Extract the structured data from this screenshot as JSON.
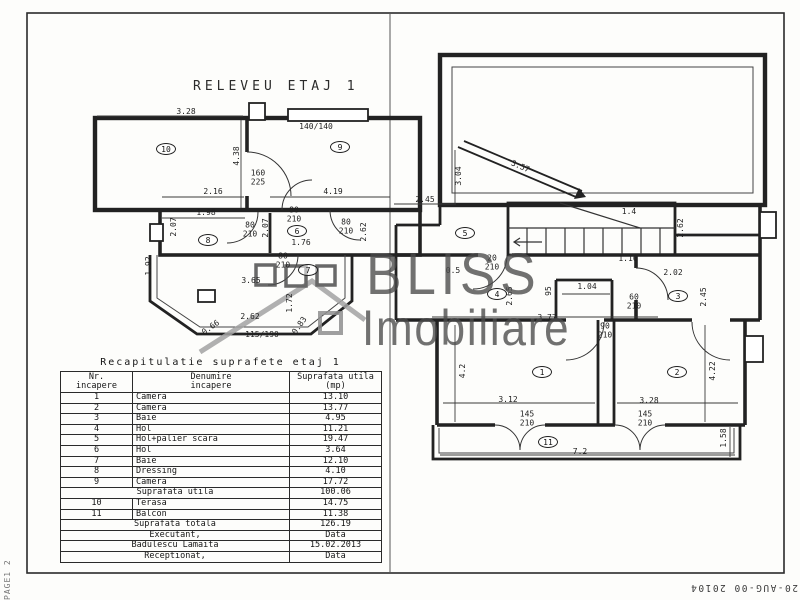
{
  "page": {
    "title": "RELEVEU ETAJ 1",
    "stamp": "20-AUG-00 20104",
    "page_label": "PAGE1 2"
  },
  "watermark": {
    "line1": "BLISS",
    "line2": "Imobiliare"
  },
  "table": {
    "title": "Recapitulatie suprafete etaj 1",
    "headers": {
      "c1": [
        "Nr.",
        "incapere"
      ],
      "c2": [
        "Denumire",
        "incapere"
      ],
      "c3": [
        "Suprafata utila",
        "(mp)"
      ]
    },
    "rows": [
      {
        "nr": "1",
        "name": "Camera",
        "value": "13.10"
      },
      {
        "nr": "2",
        "name": "Camera",
        "value": "13.77"
      },
      {
        "nr": "3",
        "name": "Baie",
        "value": "4.95"
      },
      {
        "nr": "4",
        "name": "Hol",
        "value": "11.21"
      },
      {
        "nr": "5",
        "name": "Hol+palier scara",
        "value": "19.47"
      },
      {
        "nr": "6",
        "name": "Hol",
        "value": "3.64"
      },
      {
        "nr": "7",
        "name": "Baie",
        "value": "12.10"
      },
      {
        "nr": "8",
        "name": "Dressing",
        "value": "4.10"
      },
      {
        "nr": "9",
        "name": "Camera",
        "value": "17.72"
      },
      {
        "merged": "Suprafata utila",
        "value": "100.06"
      },
      {
        "nr": "10",
        "name": "Terasa",
        "value": "14.75"
      },
      {
        "nr": "11",
        "name": "Balcon",
        "value": "11.38"
      },
      {
        "merged": "Suprafata totala",
        "value": "126.19"
      },
      {
        "merged": "Executant,",
        "value": "Data"
      },
      {
        "merged": "Badulescu Lamaita",
        "value": "15.02.2013"
      },
      {
        "merged": "Receptionat,",
        "value": "Data"
      }
    ]
  },
  "plan": {
    "rooms": [
      {
        "n": "1",
        "x": 542,
        "y": 372
      },
      {
        "n": "2",
        "x": 677,
        "y": 372
      },
      {
        "n": "3",
        "x": 678,
        "y": 296
      },
      {
        "n": "4",
        "x": 497,
        "y": 294
      },
      {
        "n": "5",
        "x": 465,
        "y": 233
      },
      {
        "n": "6",
        "x": 297,
        "y": 231
      },
      {
        "n": "7",
        "x": 308,
        "y": 270
      },
      {
        "n": "8",
        "x": 208,
        "y": 240
      },
      {
        "n": "9",
        "x": 340,
        "y": 147
      },
      {
        "n": "10",
        "x": 166,
        "y": 149
      },
      {
        "n": "11",
        "x": 548,
        "y": 442
      }
    ],
    "labels": [
      {
        "t": "3.28",
        "x": 186,
        "y": 112
      },
      {
        "t": "140/140",
        "x": 316,
        "y": 127
      },
      {
        "t": "4.38",
        "x": 237,
        "y": 156,
        "r": -90
      },
      {
        "t": "160\n225",
        "x": 258,
        "y": 178
      },
      {
        "t": "2.16",
        "x": 213,
        "y": 192
      },
      {
        "t": "4.19",
        "x": 333,
        "y": 192
      },
      {
        "t": "1.98",
        "x": 206,
        "y": 213
      },
      {
        "t": "2.07",
        "x": 174,
        "y": 227,
        "r": -90
      },
      {
        "t": "2.07",
        "x": 266,
        "y": 228,
        "r": -90
      },
      {
        "t": "80\n210",
        "x": 294,
        "y": 215
      },
      {
        "t": "80\n210",
        "x": 250,
        "y": 230
      },
      {
        "t": "80\n210",
        "x": 346,
        "y": 227
      },
      {
        "t": "1.76",
        "x": 301,
        "y": 243
      },
      {
        "t": "80\n210",
        "x": 283,
        "y": 261
      },
      {
        "t": "2.62",
        "x": 364,
        "y": 232,
        "r": -90
      },
      {
        "t": "1.92",
        "x": 149,
        "y": 266,
        "r": -90
      },
      {
        "t": "3.65",
        "x": 251,
        "y": 281
      },
      {
        "t": "1.72",
        "x": 290,
        "y": 303,
        "r": -90
      },
      {
        "t": "2.62",
        "x": 250,
        "y": 317
      },
      {
        "t": "115/190",
        "x": 262,
        "y": 335
      },
      {
        "t": "0.66",
        "x": 211,
        "y": 328,
        "r": -35
      },
      {
        "t": "0.83",
        "x": 300,
        "y": 326,
        "r": -55
      },
      {
        "t": "3.57",
        "x": 520,
        "y": 167,
        "r": 23
      },
      {
        "t": "3.04",
        "x": 459,
        "y": 176,
        "r": -90
      },
      {
        "t": "2.45",
        "x": 425,
        "y": 200
      },
      {
        "t": "1.4",
        "x": 629,
        "y": 212
      },
      {
        "t": "1.16",
        "x": 628,
        "y": 259
      },
      {
        "t": "2.62",
        "x": 681,
        "y": 228,
        "r": -90
      },
      {
        "t": "20\n210",
        "x": 492,
        "y": 263
      },
      {
        "t": "0.5",
        "x": 453,
        "y": 271
      },
      {
        "t": "2.65",
        "x": 510,
        "y": 296,
        "r": -90
      },
      {
        "t": "95",
        "x": 549,
        "y": 291,
        "r": -90
      },
      {
        "t": "1.04",
        "x": 587,
        "y": 287
      },
      {
        "t": "60\n210",
        "x": 634,
        "y": 302
      },
      {
        "t": "2.02",
        "x": 673,
        "y": 273
      },
      {
        "t": "2.45",
        "x": 704,
        "y": 297,
        "r": -90
      },
      {
        "t": "3.77",
        "x": 547,
        "y": 318
      },
      {
        "t": "90\n210",
        "x": 605,
        "y": 331
      },
      {
        "t": "4.2",
        "x": 463,
        "y": 371,
        "r": -90
      },
      {
        "t": "4.22",
        "x": 713,
        "y": 371,
        "r": -90
      },
      {
        "t": "3.12",
        "x": 508,
        "y": 400
      },
      {
        "t": "3.28",
        "x": 649,
        "y": 401
      },
      {
        "t": "145\n210",
        "x": 527,
        "y": 419
      },
      {
        "t": "145\n210",
        "x": 645,
        "y": 419
      },
      {
        "t": "7.2",
        "x": 580,
        "y": 452
      },
      {
        "t": "1.58",
        "x": 724,
        "y": 438,
        "r": -90
      }
    ]
  }
}
